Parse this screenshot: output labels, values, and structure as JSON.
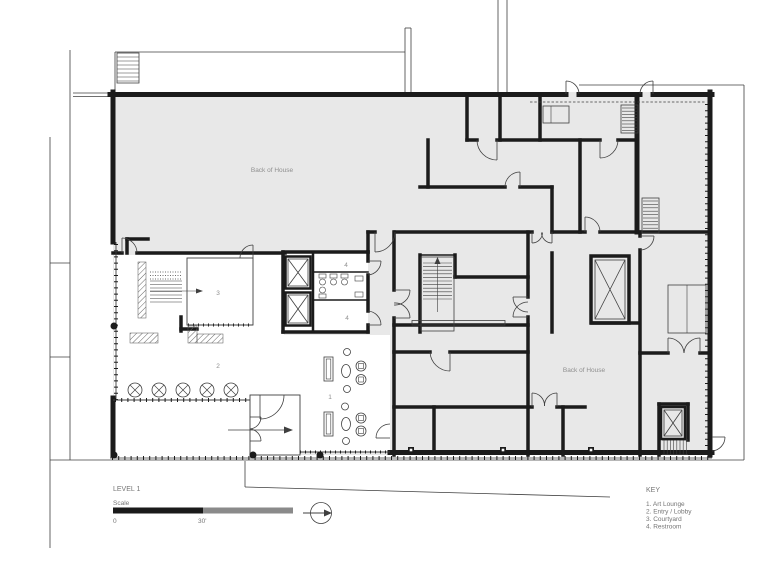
{
  "plan": {
    "title": "LEVEL 1",
    "scale": {
      "label": "Scale",
      "zero": "0",
      "thirty": "30'"
    },
    "key": {
      "title": "KEY",
      "items": [
        "1. Art Lounge",
        "2. Entry / Lobby",
        "3. Courtyard",
        "4. Restroom"
      ]
    },
    "areas": {
      "back_of_house_top": "Back of House",
      "back_of_house_right": "Back of House"
    },
    "rooms": {
      "art_lounge": "1",
      "entry_lobby": "2",
      "courtyard": "3",
      "restroom_a": "4",
      "restroom_b": "4"
    },
    "icons": {
      "north_arrow": "north-arrow",
      "elevator": "elevator-x-symbol",
      "column": "column-x-symbol"
    },
    "colors": {
      "paper": "#ffffff",
      "floor": "#e8e8e8",
      "wall": "#1b1b1b",
      "line": "#3f3f3f",
      "hatch": "#666666",
      "label": "#8f8f8f",
      "meta": "#757575",
      "scale_black": "#1a1a1a",
      "scale_gray": "#8a8a8a"
    }
  }
}
